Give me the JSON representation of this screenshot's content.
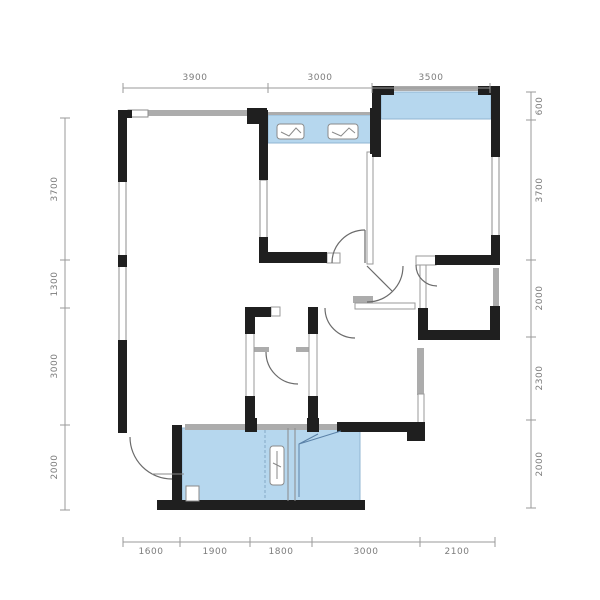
{
  "figure": {
    "type": "residential-floor-plan",
    "background": "#ffffff",
    "units": "mm"
  },
  "colors": {
    "wall": "#1f1f1f",
    "gray_wall": "#acacac",
    "glass": "#b6d7ee",
    "glass_edge": "#90b4d2",
    "dim_line": "#9a9a9a",
    "dim_text": "#7c7c7c",
    "door_line": "#6b6b6b",
    "accent_blue": "#5b82a8"
  },
  "icons": {
    "window_marker": "window-sash-icon",
    "door_swing": "door-swing-arc-icon",
    "glazing_panel": "glass-panel"
  },
  "dims": {
    "top": [
      "3900",
      "3000",
      "3500"
    ],
    "left": [
      "3700",
      "1300",
      "3000",
      "2000"
    ],
    "right": [
      "600",
      "3700",
      "2000",
      "2300",
      "2000"
    ],
    "bottom": [
      "1600",
      "1900",
      "1800",
      "3000",
      "2100"
    ]
  }
}
